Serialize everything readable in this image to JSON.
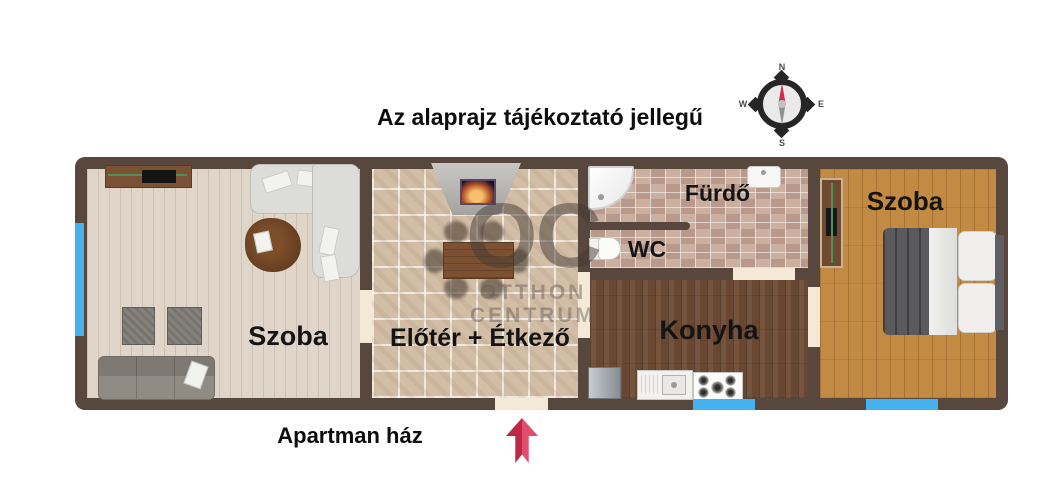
{
  "title": "Az alaprajz tájékoztató jellegű",
  "plan_caption": "Apartman ház",
  "compass": {
    "north": "N",
    "east": "E",
    "south": "S",
    "west": "W"
  },
  "watermark": {
    "monogram": "OC",
    "line1": "OTTHON",
    "line2": "CENTRUM"
  },
  "rooms": {
    "living": {
      "label": "Szoba"
    },
    "hall": {
      "label": "Előtér + Étkező"
    },
    "bathroom": {
      "label": "Fürdő"
    },
    "wc": {
      "label": "WC"
    },
    "kitchen": {
      "label": "Konyha"
    },
    "bedroom": {
      "label": "Szoba"
    }
  },
  "colors": {
    "wall": "#57473c",
    "window": "#45b2ef",
    "door_gap": "#f3e9d6",
    "entrance_arrow": "#ce2b4d",
    "compass_needle": "#ce2b4d"
  }
}
